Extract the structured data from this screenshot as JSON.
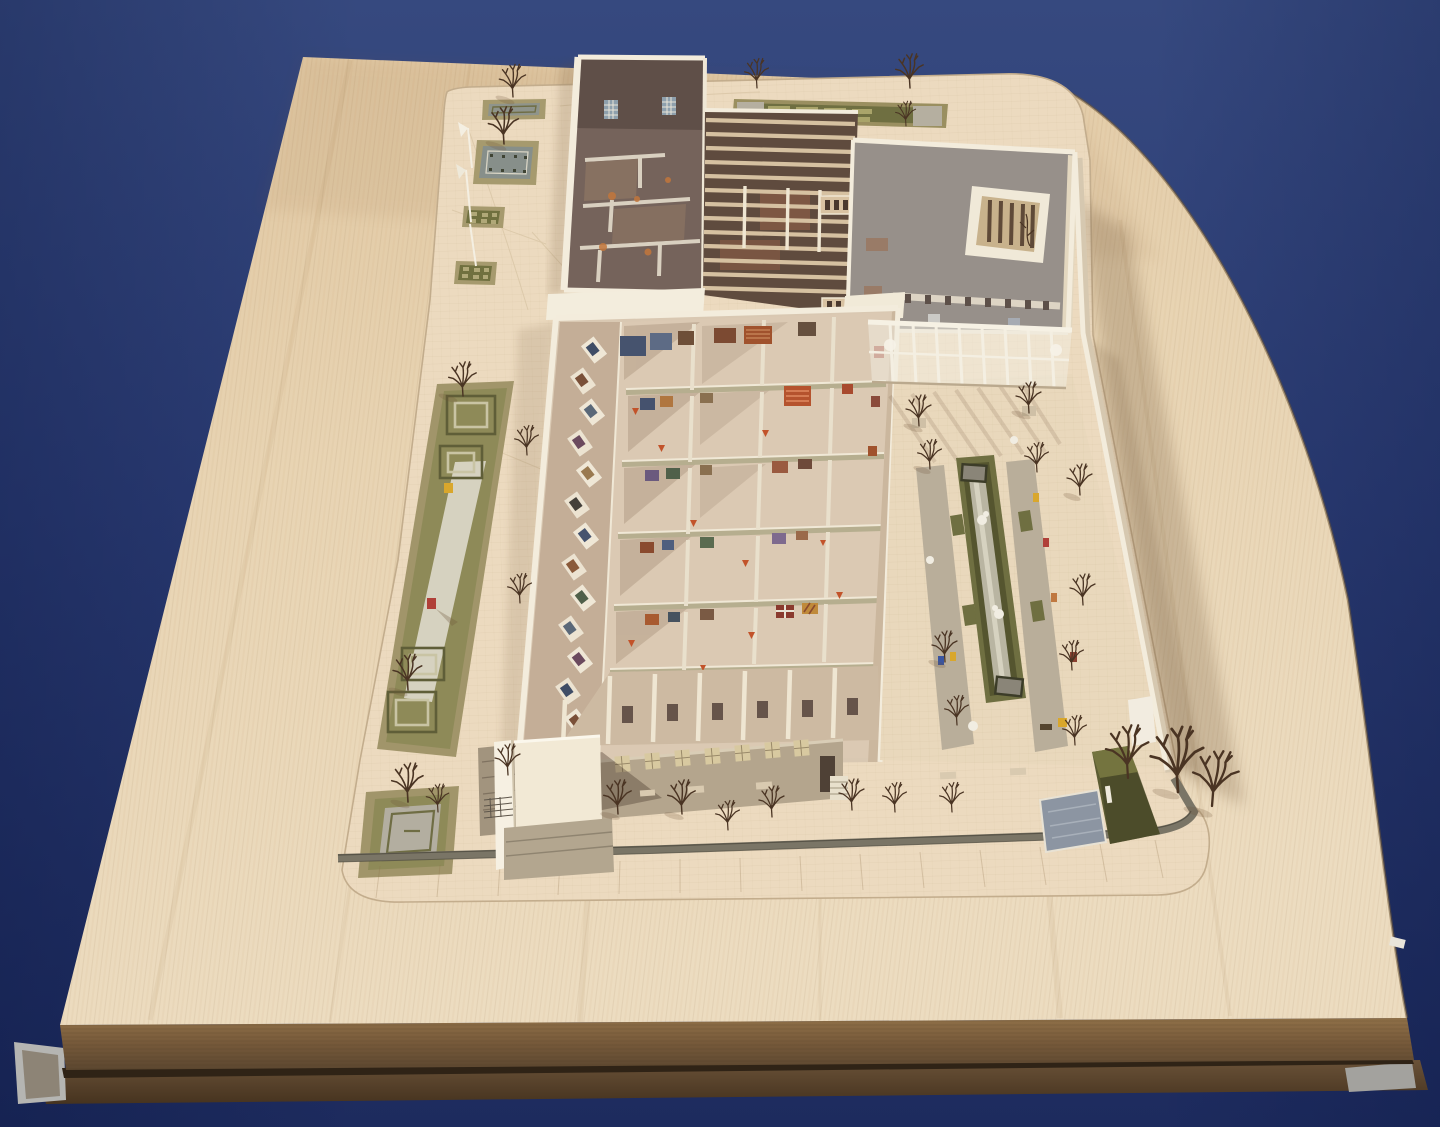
{
  "photo": {
    "background": {
      "top": "#36497f",
      "mid": "#2b3c74",
      "bottom": "#1d2b5e"
    },
    "board": {
      "wood_light": "#ecd9ba",
      "wood_mid": "#e2cba6",
      "wood_dark": "#d3b78c",
      "side": "#7c6140",
      "plinth": "#55402a",
      "metal": "#b5b5b2",
      "edge_tag": "#e8e4da"
    },
    "site": {
      "paving": "#ecdabf",
      "grid_line": "#c3ad8d",
      "sidewalk": "#e7d5b8"
    },
    "model": {
      "wall_white": "#f3ecdc",
      "wall_cream": "#d9c8b2",
      "wall_sage": "#b6ae8f",
      "corridor_floor": "#c4ae97",
      "portico_floor": "#cdbaa2",
      "interior_dark": "#75635b",
      "interior_darker": "#5f4f48",
      "interior_gray": "#97908a",
      "rib_light": "#d6c1a1",
      "rib_base": "#5f4b3e",
      "facade": "#b4a58d",
      "window": "#d8c9a0",
      "door_dark": "#4f4136",
      "skylight_frame": "#f0e9d8",
      "skylight_court": "#c8b28c",
      "hedge": "#6f6f41",
      "hedge_dark": "#55552f",
      "hedge_light": "#a9a46a",
      "khaki": "#a1956a",
      "garden_green": "#8e8a58",
      "gravel_pale": "#d6d2c0",
      "parterre_gray": "#8f948b",
      "path_gravel": "#b9ae9a",
      "pool": "#8c95a2",
      "wedge": "#5c5c33",
      "wedge_top": "#74743f",
      "fence": "#7a7566",
      "tree": "#4a3423",
      "glow_orange": "#c2763c",
      "accent_triangle": "#c2532a",
      "figure_yellow": "#d9a72c",
      "figure_red": "#b04038",
      "figure_blue": "#3a55a0",
      "art_navy": "#46536e",
      "art_blue": "#5d6b85",
      "art_rust": "#a0522d",
      "art_red_stripe": "#b5532e",
      "art_brown": "#7c4a32",
      "art_plum": "#6b5a7e"
    }
  }
}
